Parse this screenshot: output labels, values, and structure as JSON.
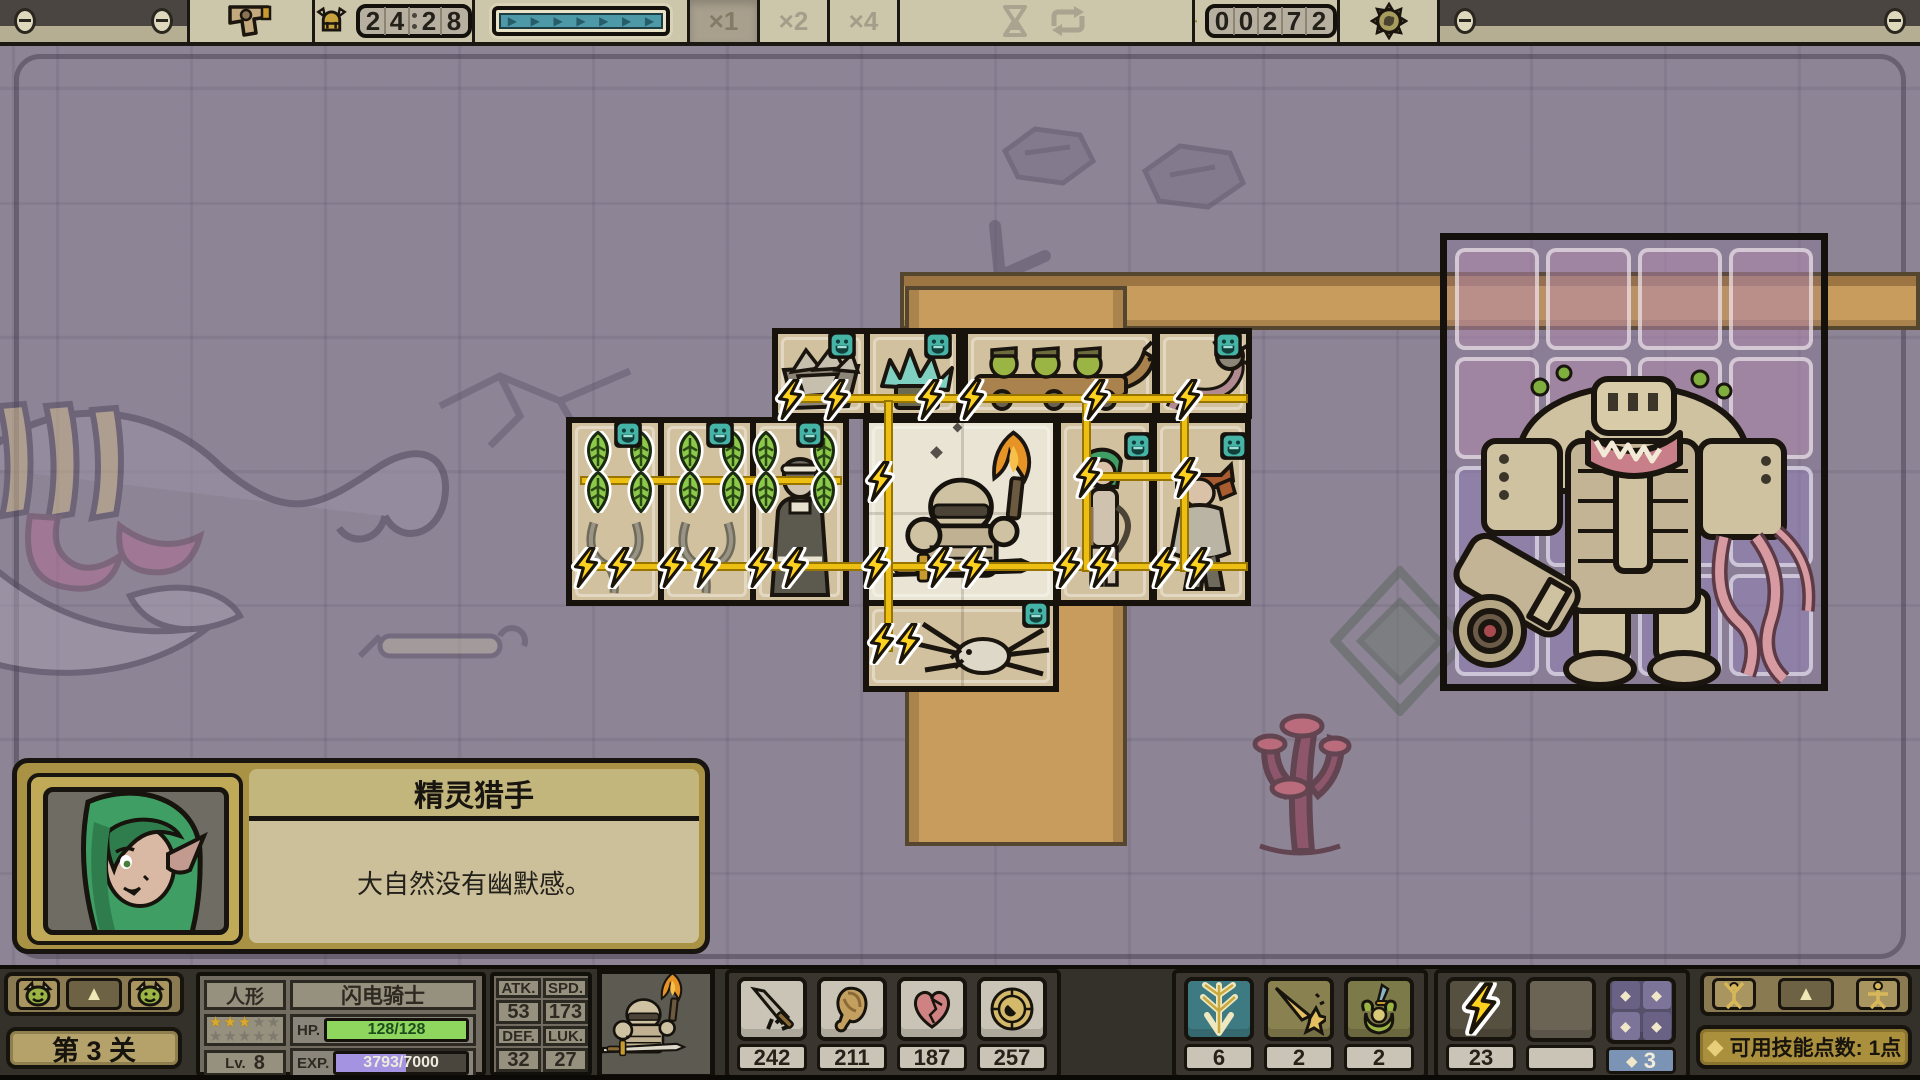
{
  "top_bar": {
    "timer_digits": [
      "2",
      "4",
      "2",
      "8"
    ],
    "speed_options": [
      {
        "label": "×1",
        "active": true
      },
      {
        "label": "×2",
        "active": false
      },
      {
        "label": "×4",
        "active": false
      }
    ],
    "coin_digits": [
      "0",
      "0",
      "2",
      "7",
      "2"
    ],
    "progress_arrow": "▶",
    "progress_arrow_count": 7
  },
  "dialog": {
    "title": "精灵猎手",
    "text": "大自然没有幽默感。"
  },
  "level_badge": "第 3 关",
  "stats": {
    "race": "人形",
    "class_name": "闪电骑士",
    "stars_gold": 3,
    "stars_total": 10,
    "hp_label": "HP.",
    "hp_value": "128/128",
    "hp_percent": 100,
    "exp_label": "EXP.",
    "exp_value": "3793/7000",
    "exp_percent": 54,
    "level_label": "Lv.",
    "level_value": "8",
    "attrs": [
      {
        "label": "ATK.",
        "value": "53"
      },
      {
        "label": "SPD.",
        "value": "173"
      },
      {
        "label": "DEF.",
        "value": "32"
      },
      {
        "label": "LUK.",
        "value": "27"
      }
    ]
  },
  "consumables": [
    {
      "icon": "sword-icon",
      "count": "242"
    },
    {
      "icon": "meat-icon",
      "count": "211"
    },
    {
      "icon": "heart-icon",
      "count": "187"
    },
    {
      "icon": "medal-icon",
      "count": "257"
    }
  ],
  "skills": [
    {
      "icon": "lightning-pylon-icon",
      "count": "6"
    },
    {
      "icon": "comet-icon",
      "count": "2"
    },
    {
      "icon": "hero-sword-icon",
      "count": "2"
    }
  ],
  "hotbar": [
    {
      "icon": "bolt-icon",
      "count": "23"
    },
    {
      "icon": "empty-slot",
      "count": ""
    },
    {
      "icon": "diamond-grid-icon",
      "count": "3"
    }
  ],
  "skill_points": {
    "label": "可用技能点数:",
    "value": "1点"
  },
  "colors": {
    "accent_gold": "#edbf13",
    "hp_green": "#8ed65e",
    "exp_purple": "#a393e0",
    "teal_face": "#45b3a6",
    "road": "#c79c5d"
  }
}
